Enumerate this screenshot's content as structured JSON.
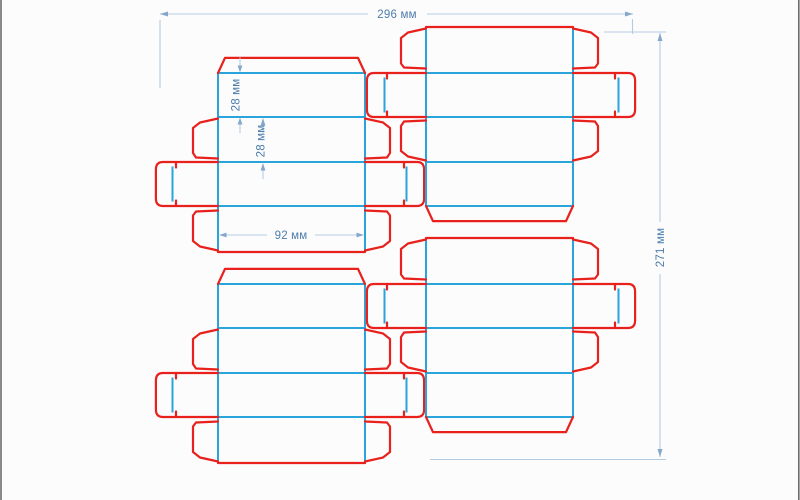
{
  "drawing": {
    "title": "box dieline layout preview",
    "blank_count": 4,
    "blanks": [
      {
        "id": "upper-left"
      },
      {
        "id": "upper-right"
      },
      {
        "id": "lower-left"
      },
      {
        "id": "lower-right"
      }
    ],
    "line_styles": {
      "cut_color": "#e8211c",
      "fold_color": "#29a5dc",
      "dimension_line_color": "#b3cbe3",
      "dimension_arrow_color": "#85a7cb",
      "dimension_text_color": "#4d7dab",
      "background_color": "#fcfcfd",
      "screen_edge_color": "#6e6e6e"
    },
    "dimensions": {
      "total_width": {
        "label": "296 мм"
      },
      "total_height": {
        "label": "271 мм"
      },
      "panel1_height": {
        "label": "28 мм"
      },
      "panel2_height": {
        "label": "28 мм"
      },
      "panel_width": {
        "label": "92 мм"
      }
    }
  }
}
